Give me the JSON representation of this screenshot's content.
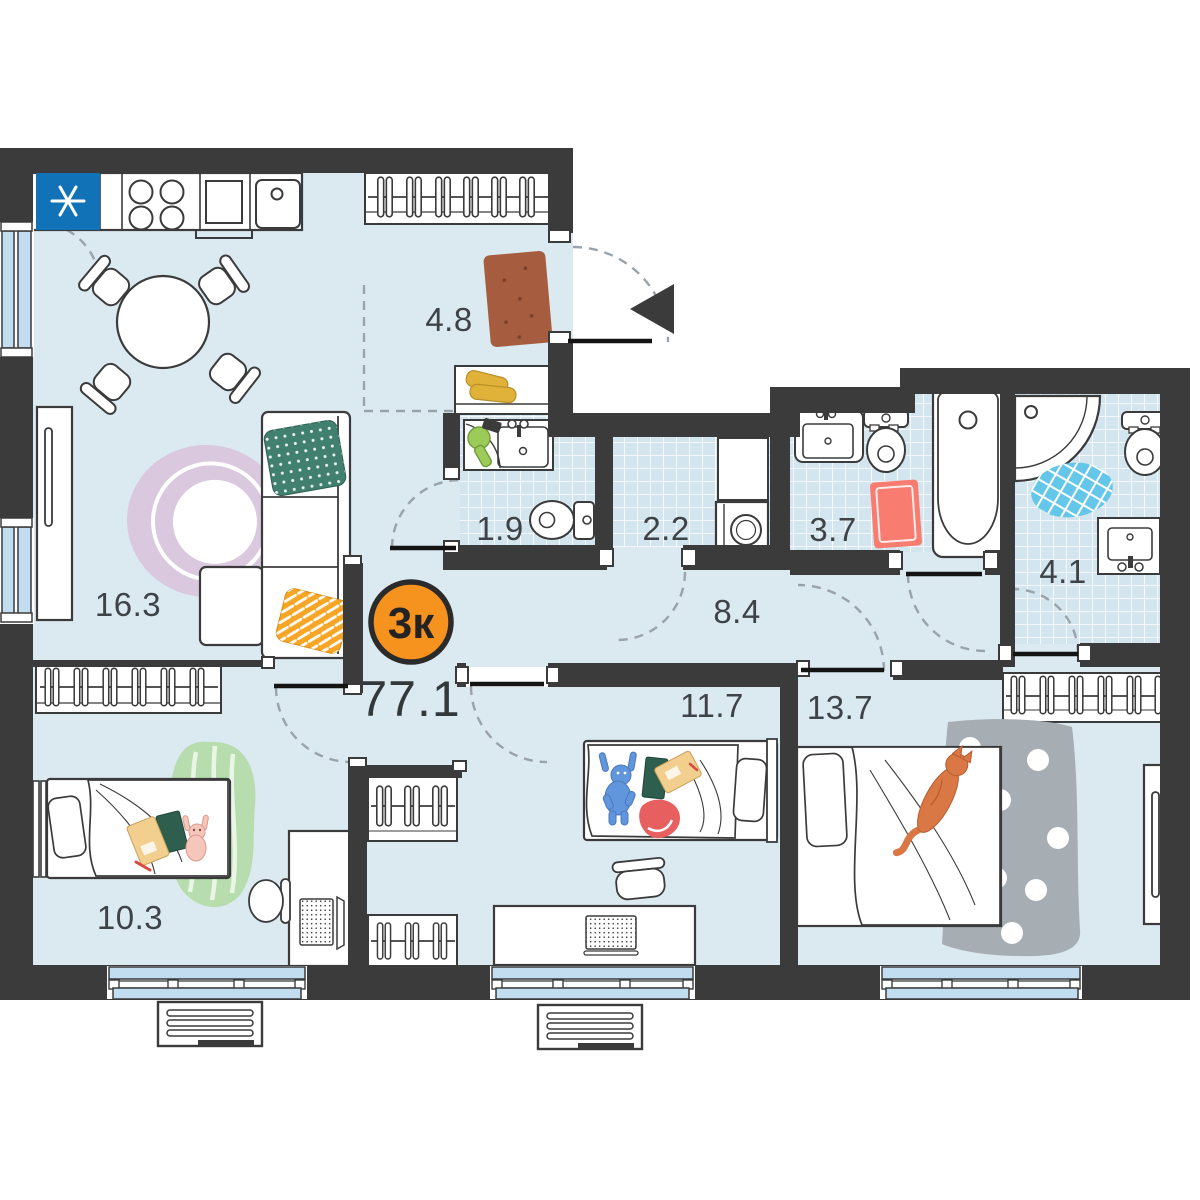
{
  "plan": {
    "badge": {
      "text": "3к"
    },
    "total_area": "77.1",
    "rooms": {
      "living": "16.3",
      "hallway": "4.8",
      "bathroom_small": "1.9",
      "laundry": "2.2",
      "bathroom": "3.7",
      "corridor": "8.4",
      "bathroom_master": "4.1",
      "bedroom_1": "10.3",
      "bedroom_2": "11.7",
      "bedroom_3": "13.7"
    },
    "colors": {
      "wall": "#3b3b3b",
      "floor": "#dbe9f1",
      "tile": "#d3e5ee",
      "window": "#c2dcf0",
      "badge": "#f6921e",
      "fridge": "#1172b7"
    }
  }
}
